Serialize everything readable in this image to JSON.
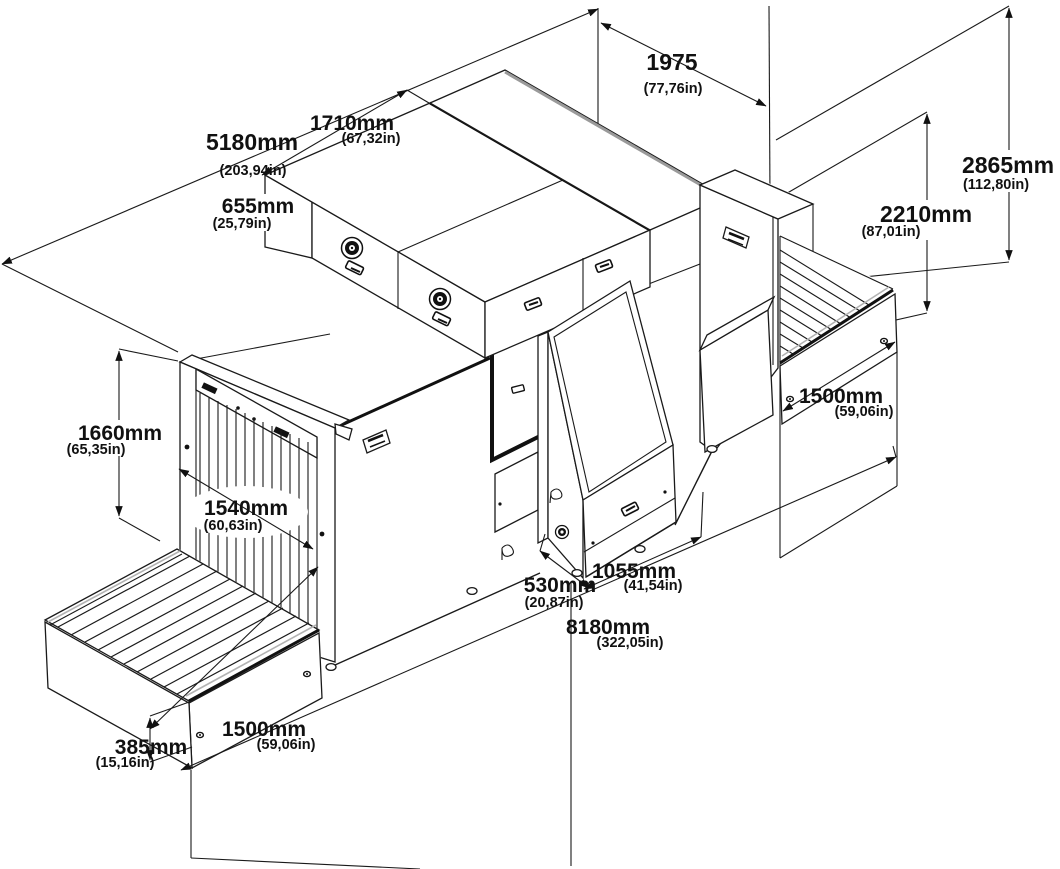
{
  "diagram": {
    "type": "isometric technical drawing",
    "subject": "baggage x-ray scanner dimensional drawing",
    "line_color": "#1a1a1a",
    "background": "#ffffff",
    "dimensions": [
      {
        "id": "overall-width",
        "mm": "5180mm",
        "in": "(203,94in)"
      },
      {
        "id": "top-cabinet-length",
        "mm": "1710mm",
        "in": "(67,32in)"
      },
      {
        "id": "top-clearance",
        "mm": "1975",
        "in": "(77,76in)"
      },
      {
        "id": "top-cabinet-height",
        "mm": "655mm",
        "in": "(25,79in)"
      },
      {
        "id": "overall-height",
        "mm": "2865mm",
        "in": "(112,80in)"
      },
      {
        "id": "body-height",
        "mm": "2210mm",
        "in": "(87,01in)"
      },
      {
        "id": "exit-conveyor-length",
        "mm": "1500mm",
        "in": "(59,06in)"
      },
      {
        "id": "portal-height",
        "mm": "1660mm",
        "in": "(65,35in)"
      },
      {
        "id": "tunnel-width",
        "mm": "1540mm",
        "in": "(60,63in)"
      },
      {
        "id": "console-depth",
        "mm": "530mm",
        "in": "(20,87in)"
      },
      {
        "id": "console-width",
        "mm": "1055mm",
        "in": "(41,54in)"
      },
      {
        "id": "overall-length",
        "mm": "8180mm",
        "in": "(322,05in)"
      },
      {
        "id": "entry-conveyor-length",
        "mm": "1500mm",
        "in": "(59,06in)"
      },
      {
        "id": "entry-conveyor-height",
        "mm": "385mm",
        "in": "(15,16in)"
      }
    ]
  }
}
